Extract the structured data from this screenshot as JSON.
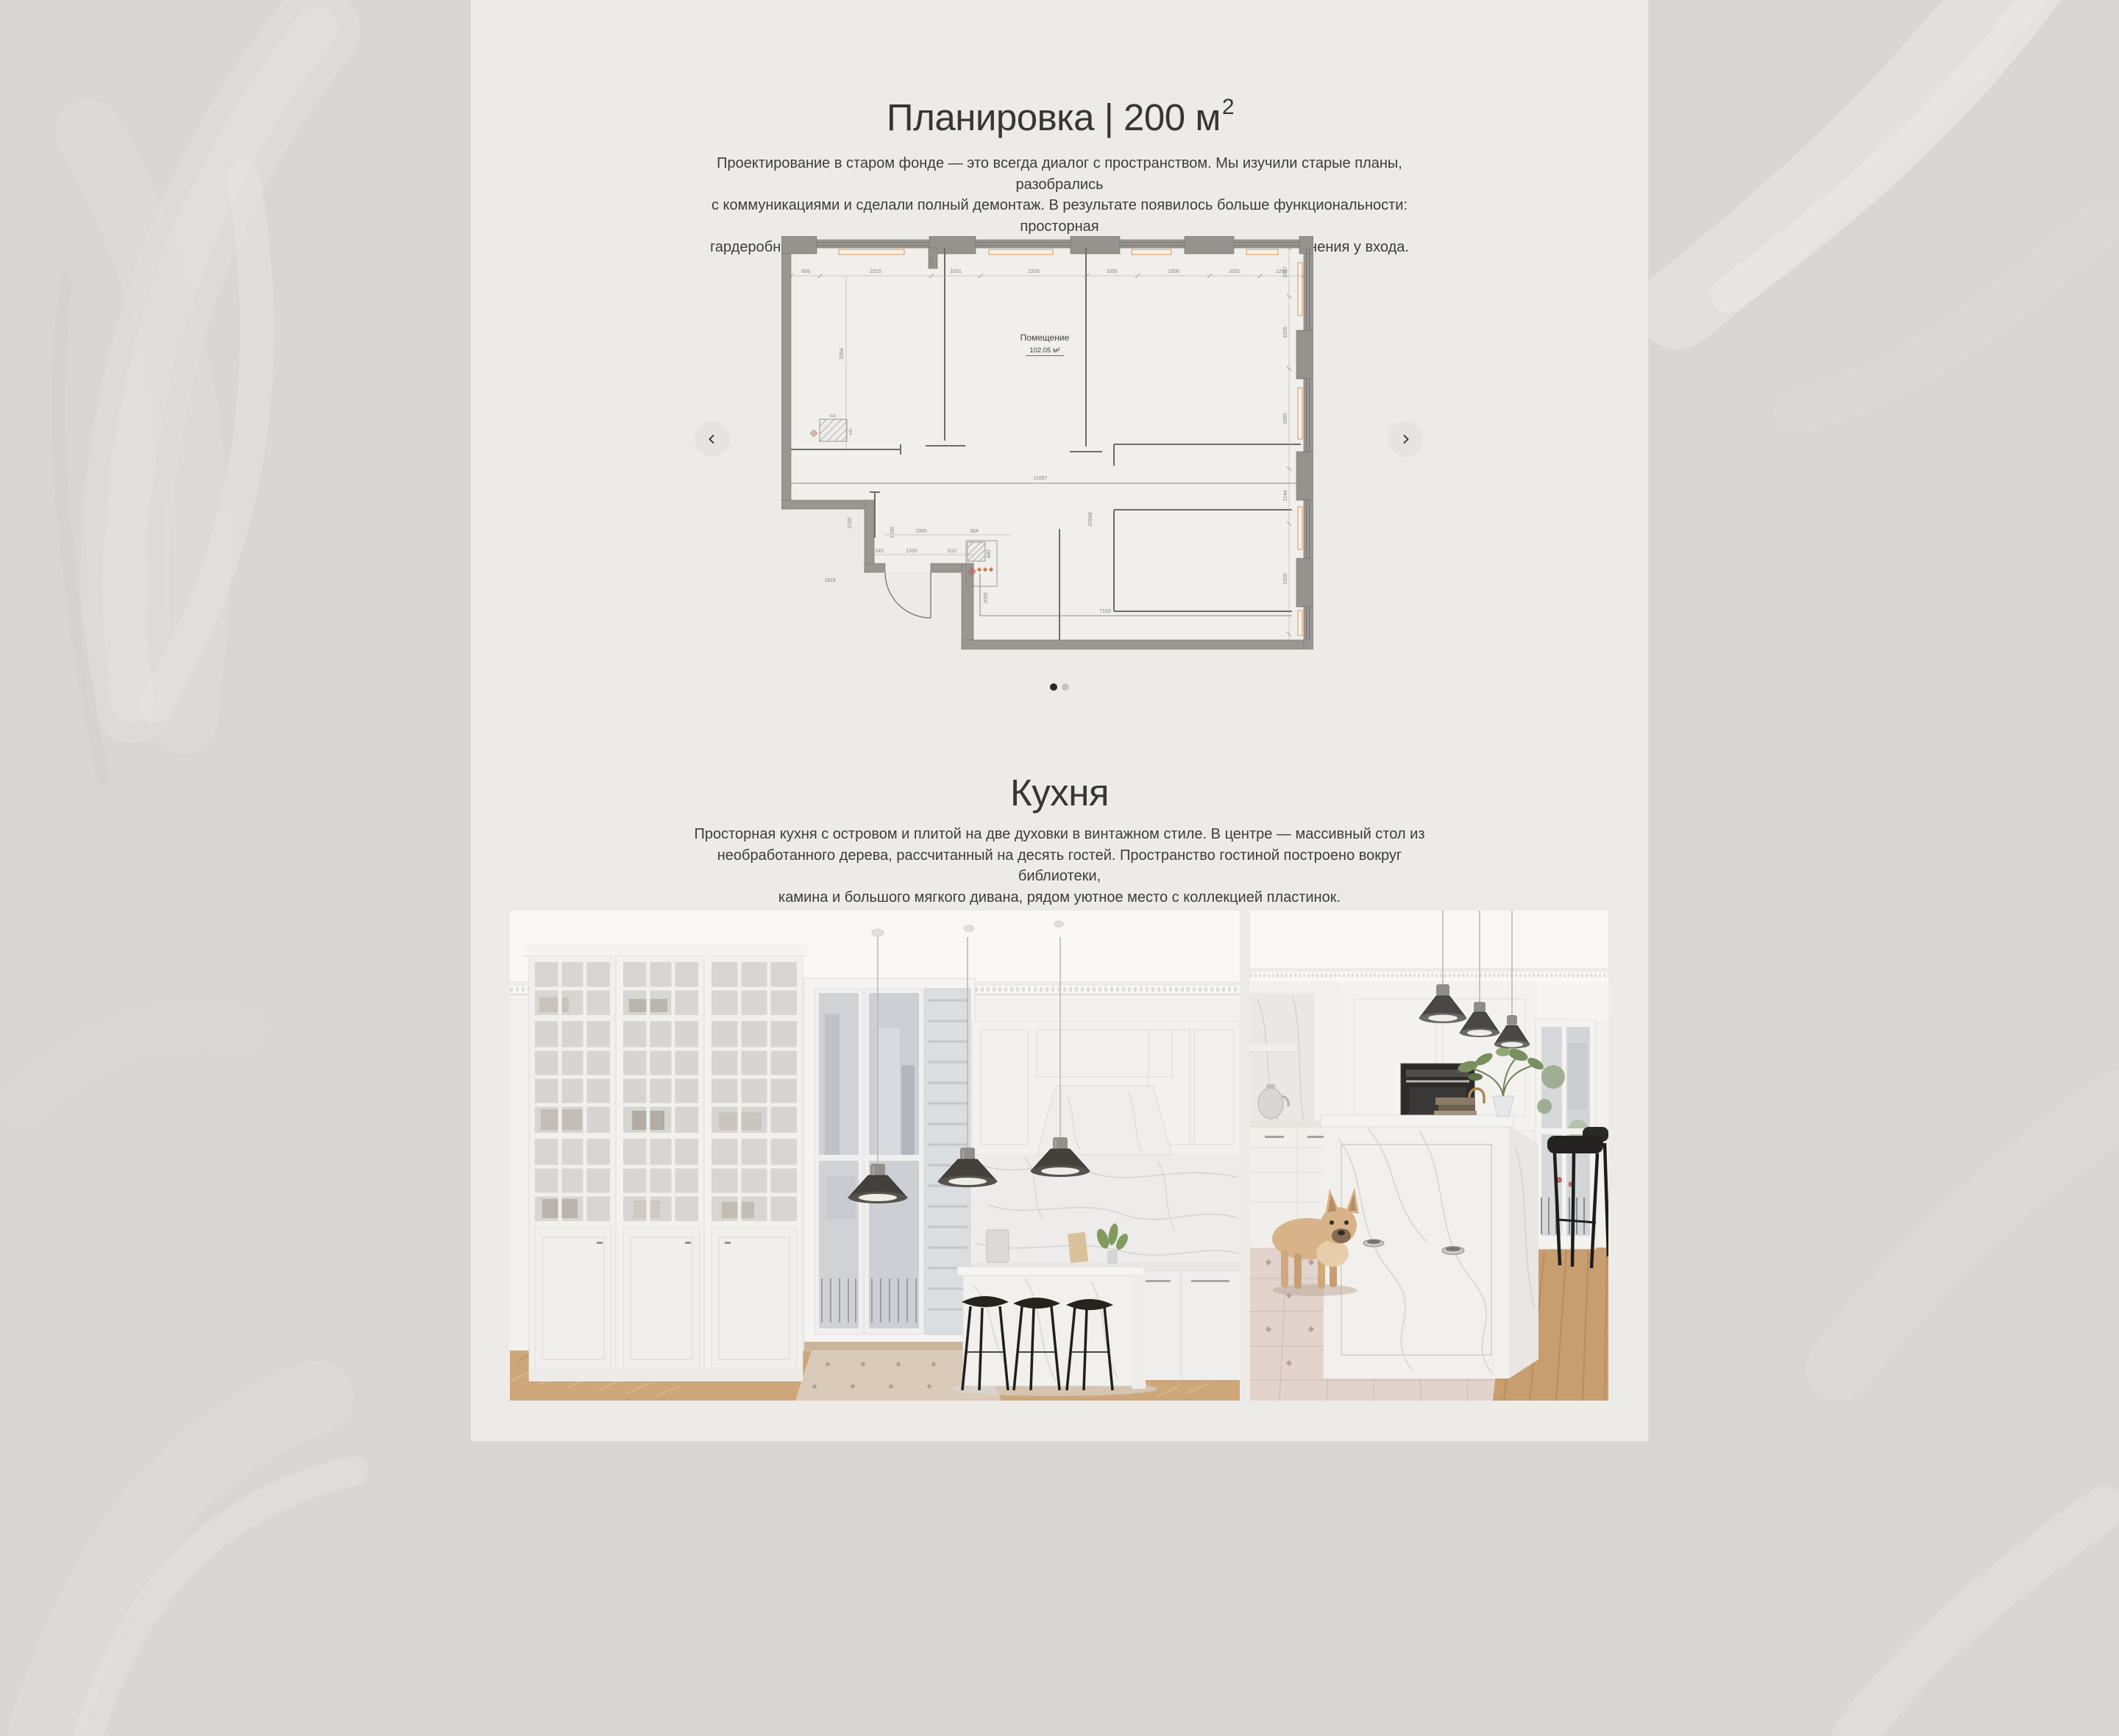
{
  "page": {
    "background_color": "#d9d6d3",
    "content_background": "#edebe8"
  },
  "plan_section": {
    "title": "Планировка | 200 м",
    "title_sup": "2",
    "description": "Проектирование в старом фонде — это всегда диалог с пространством. Мы изучили старые планы, разобрались\nс коммуникациями и сделали полный демонтаж. В результате появилось больше функциональности: просторная\nгардеробная в мастер-блоке, увеличенный санузел, отдельная прачечная, система хранения у входа.",
    "carousel": {
      "prev_icon": "chevron-left",
      "next_icon": "chevron-right",
      "active_slide": 0,
      "slide_count": 2
    },
    "floor_plan": {
      "room_label": "Помещение",
      "room_area": "102.05 м²",
      "dims_top": [
        "608",
        "2315",
        "1031",
        "2200",
        "1055",
        "1500",
        "1051",
        "1298"
      ],
      "dim_width_total": "11067",
      "dim_height_total": "10548",
      "dims_right": [
        "1017",
        "1505",
        "2085",
        "1144",
        "2300"
      ],
      "dims_left": [
        "3354",
        "2190",
        "1819"
      ],
      "dims_bottom": [
        "1700",
        "2955",
        "364",
        "245",
        "1200",
        "610",
        "480",
        "2055",
        "7193"
      ],
      "dims_misc": [
        "981",
        "615",
        "442"
      ]
    }
  },
  "kitchen_section": {
    "title": "Кухня",
    "description": "Просторная кухня с островом и плитой на две духовки в винтажном стиле. В центре — массивный стол из\nнеобработанного дерева, рассчитанный на десять гостей. Пространство гостиной построено вокруг библиотеки,\nкамина и большого мягкого дивана, рядом уютное место с коллекцией пластинок.",
    "photos": [
      {
        "name": "kitchen-photo-1"
      },
      {
        "name": "kitchen-photo-2"
      }
    ]
  }
}
